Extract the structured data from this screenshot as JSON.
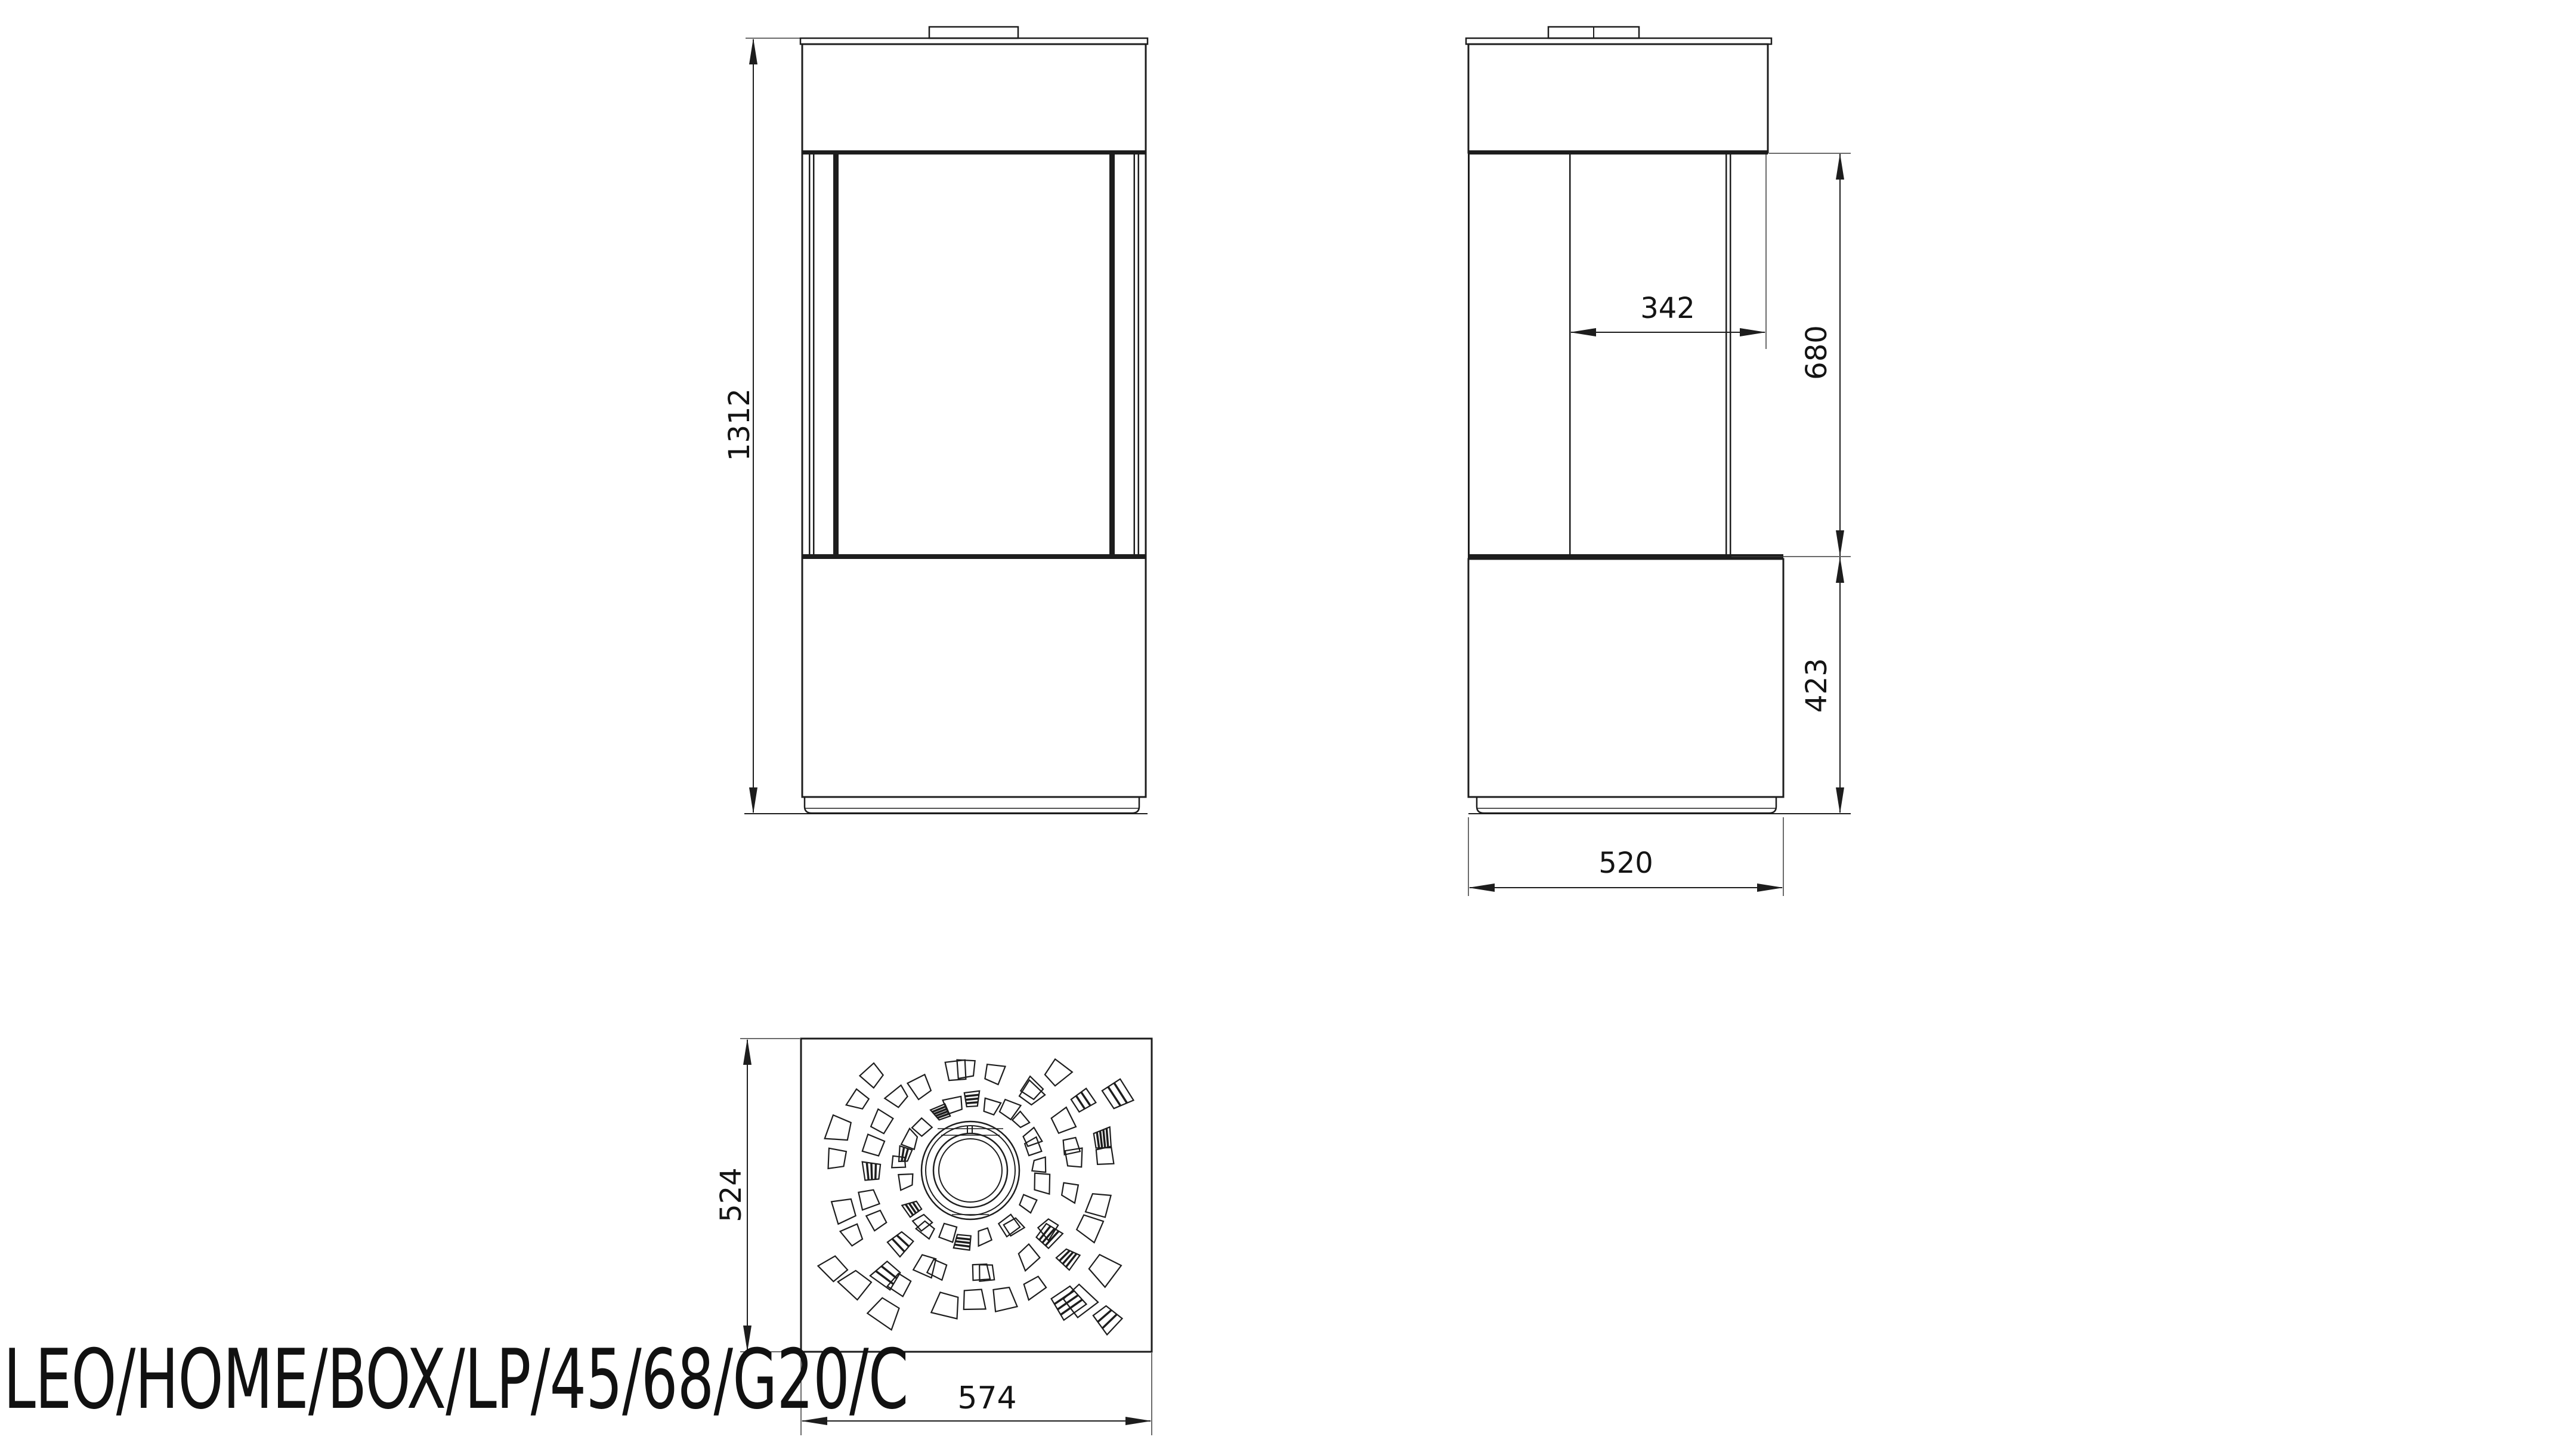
{
  "title": {
    "model_label": "LEO/HOME/BOX/LP/45/68/G20/C"
  },
  "dimensions": {
    "overall_height": "1312",
    "firebox_depth": "342",
    "glass_height": "680",
    "base_height": "423",
    "body_depth": "520",
    "top_plate_depth": "524",
    "top_plate_width": "574"
  },
  "colors": {
    "line": "#1d1d1d",
    "thin_line": "#3a3a3a",
    "background": "#ffffff"
  }
}
